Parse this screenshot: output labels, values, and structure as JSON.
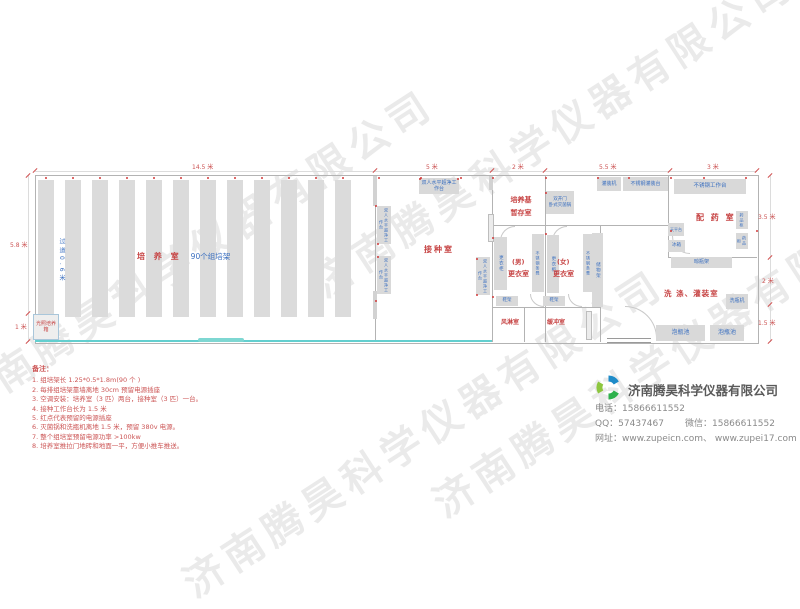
{
  "watermark": "济南腾昊科学仪器有限公司",
  "plan": {
    "dims": {
      "top": [
        "14.5 米",
        "5 米",
        "2 米",
        "5.5 米",
        "3 米"
      ],
      "left": [
        "5.8 米",
        "1 米"
      ],
      "right": [
        "3.5 米",
        "2 米",
        "1.5 米"
      ]
    },
    "culture_room": {
      "label": "培 养 室",
      "racks_label": "90个组培架",
      "aisle": "过道0.6米",
      "incubator": "光照培养箱"
    },
    "inoculation_room": {
      "label": "接种室",
      "bench": "双人水平超净工作台"
    },
    "medium_room": {
      "line1": "培养基",
      "line2": "暂存室"
    },
    "sterilizer": {
      "line1": "双开门",
      "line2": "卧式灭菌锅"
    },
    "filling": {
      "machine": "灌装机",
      "table": "不锈钢灌装台"
    },
    "pharmacy": {
      "label": "配 药 室",
      "worktable": "不锈钢工作台",
      "balance": "天平台",
      "fridge": "冰箱",
      "cabinet": "药品柜"
    },
    "changing_male": {
      "label1": "(男)",
      "label2": "更衣室"
    },
    "changing_female": {
      "label1": "(女)",
      "label2": "更衣室"
    },
    "locker": "更衣柜",
    "steel_bench": "不锈钢条凳",
    "shoe_rack": "鞋架",
    "storage_rack": "储物架",
    "air_shower": "风淋室",
    "buffer_room": "缓冲室",
    "washing_room": {
      "label": "洗 涤、灌装室",
      "dry_rack": "晾瓶架",
      "washer": "洗瓶机",
      "pool": "泡瓶池"
    }
  },
  "notes": {
    "title": "备注：",
    "items": [
      "1. 组培架长 1.25*0.5*1.8m(90 个 )",
      "2. 每排组培架靠墙离地 30cm 预留电源插座",
      "3. 空调安装：培养室（3 匹）两台，接种室（3 匹）一台。",
      "4. 接种工作台长为 1.5 米",
      "5. 红点代表预留的电源插座",
      "6. 灭菌锅和洗瓶机离地 1.5 米，预留 380v 电源。",
      "7. 整个组培室预留电源功率 >100kw",
      "8. 培养室推拉门地砖和地面一平，方便小推车推送。"
    ]
  },
  "company": {
    "name": "济南腾昊科学仪器有限公司",
    "phone": "电话：15866611552",
    "qq": "QQ：57437467",
    "wechat": "微信：15866611552",
    "website": "网址：www.zupeicn.com、 www.zupei17.com"
  }
}
